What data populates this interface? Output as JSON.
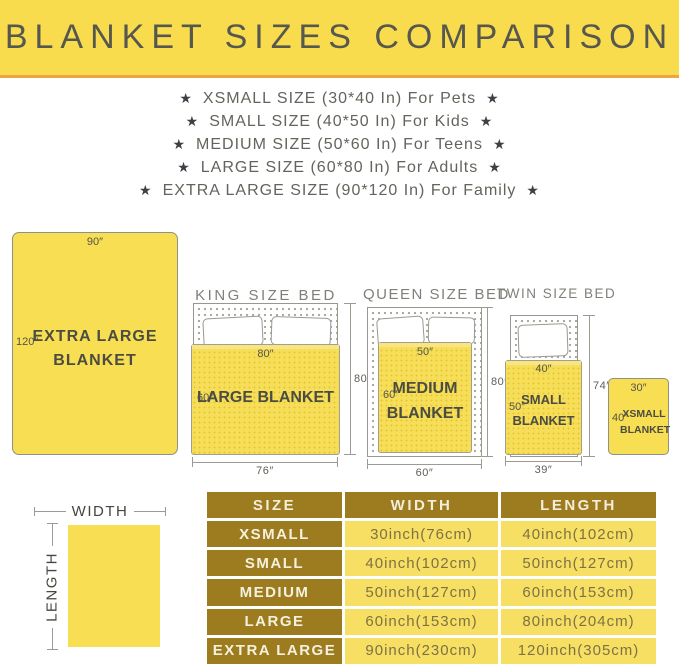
{
  "banner": {
    "title": "BLANKET SIZES COMPARISON"
  },
  "size_list": {
    "star": "★",
    "items": [
      {
        "text": "XSMALL SIZE (30*40 In) For Pets"
      },
      {
        "text": "SMALL SIZE (40*50 In) For Kids"
      },
      {
        "text": "MEDIUM SIZE (50*60 In) For Teens"
      },
      {
        "text": "LARGE SIZE (60*80 In) For Adults"
      },
      {
        "text": "EXTRA LARGE SIZE (90*120 In) For Family"
      }
    ]
  },
  "diagrams": {
    "extra_large_blanket": {
      "width": "90″",
      "length": "120″",
      "name_line1": "EXTRA LARGE",
      "name_line2": "BLANKET"
    },
    "king": {
      "title": "KING SIZE BED",
      "blanket_top": "80″",
      "blanket_side": "60″",
      "blanket_name": "LARGE BLANKET",
      "bed_side": "80″",
      "bed_bottom": "76″"
    },
    "queen": {
      "title": "QUEEN SIZE BED",
      "blanket_top": "50″",
      "blanket_side": "60″",
      "blanket_name_line1": "MEDIUM",
      "blanket_name_line2": "BLANKET",
      "bed_side": "80″",
      "bed_bottom": "60″"
    },
    "twin": {
      "title": "TWIN SIZE BED",
      "blanket_top": "40″",
      "blanket_side": "50″",
      "blanket_name_line1": "SMALL",
      "blanket_name_line2": "BLANKET",
      "bed_side": "74″",
      "bed_bottom": "39″"
    },
    "xsmall_blanket": {
      "width": "30″",
      "length": "40″",
      "name_line1": "XSMALL",
      "name_line2": "BLANKET"
    }
  },
  "legend": {
    "width": "WIDTH",
    "length": "LENGTH"
  },
  "size_table": {
    "headers": [
      "SIZE",
      "WIDTH",
      "LENGTH"
    ],
    "rows": [
      {
        "size": "XSMALL",
        "width": "30inch(76cm)",
        "length": "40inch(102cm)"
      },
      {
        "size": "SMALL",
        "width": "40inch(102cm)",
        "length": "50inch(127cm)"
      },
      {
        "size": "MEDIUM",
        "width": "50inch(127cm)",
        "length": "60inch(153cm)"
      },
      {
        "size": "LARGE",
        "width": "60inch(153cm)",
        "length": "80inch(204cm)"
      },
      {
        "size": "EXTRA LARGE",
        "width": "90inch(230cm)",
        "length": "120inch(305cm)"
      }
    ]
  },
  "colors": {
    "banner_bg": "#F8DC4D",
    "banner_accent": "#EFA53E",
    "blanket_yellow": "#F6DE58",
    "table_gold": "#9C7C1F",
    "table_yellow": "#F6DF62"
  }
}
